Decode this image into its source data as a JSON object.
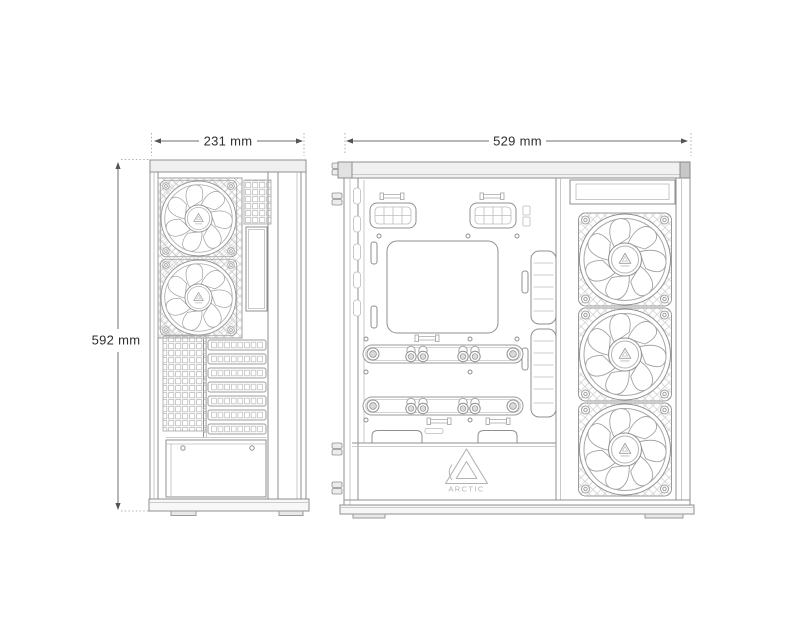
{
  "page": {
    "background": "#ffffff",
    "kind": "case-dimension-drawing"
  },
  "dimensions": {
    "width": "231 mm",
    "height": "592 mm",
    "depth": "529 mm"
  },
  "brand": {
    "logo_text": "ARCTIC"
  },
  "views": {
    "rear_view": {
      "fans": 2,
      "expansion_slots": 7
    },
    "side_view": {
      "fans": 3
    }
  },
  "colors": {
    "line_main": "#8f8f8f",
    "line_light": "#b9b9b9",
    "dimension_text": "#2e2e2e",
    "logo": "#b3b3b3"
  }
}
